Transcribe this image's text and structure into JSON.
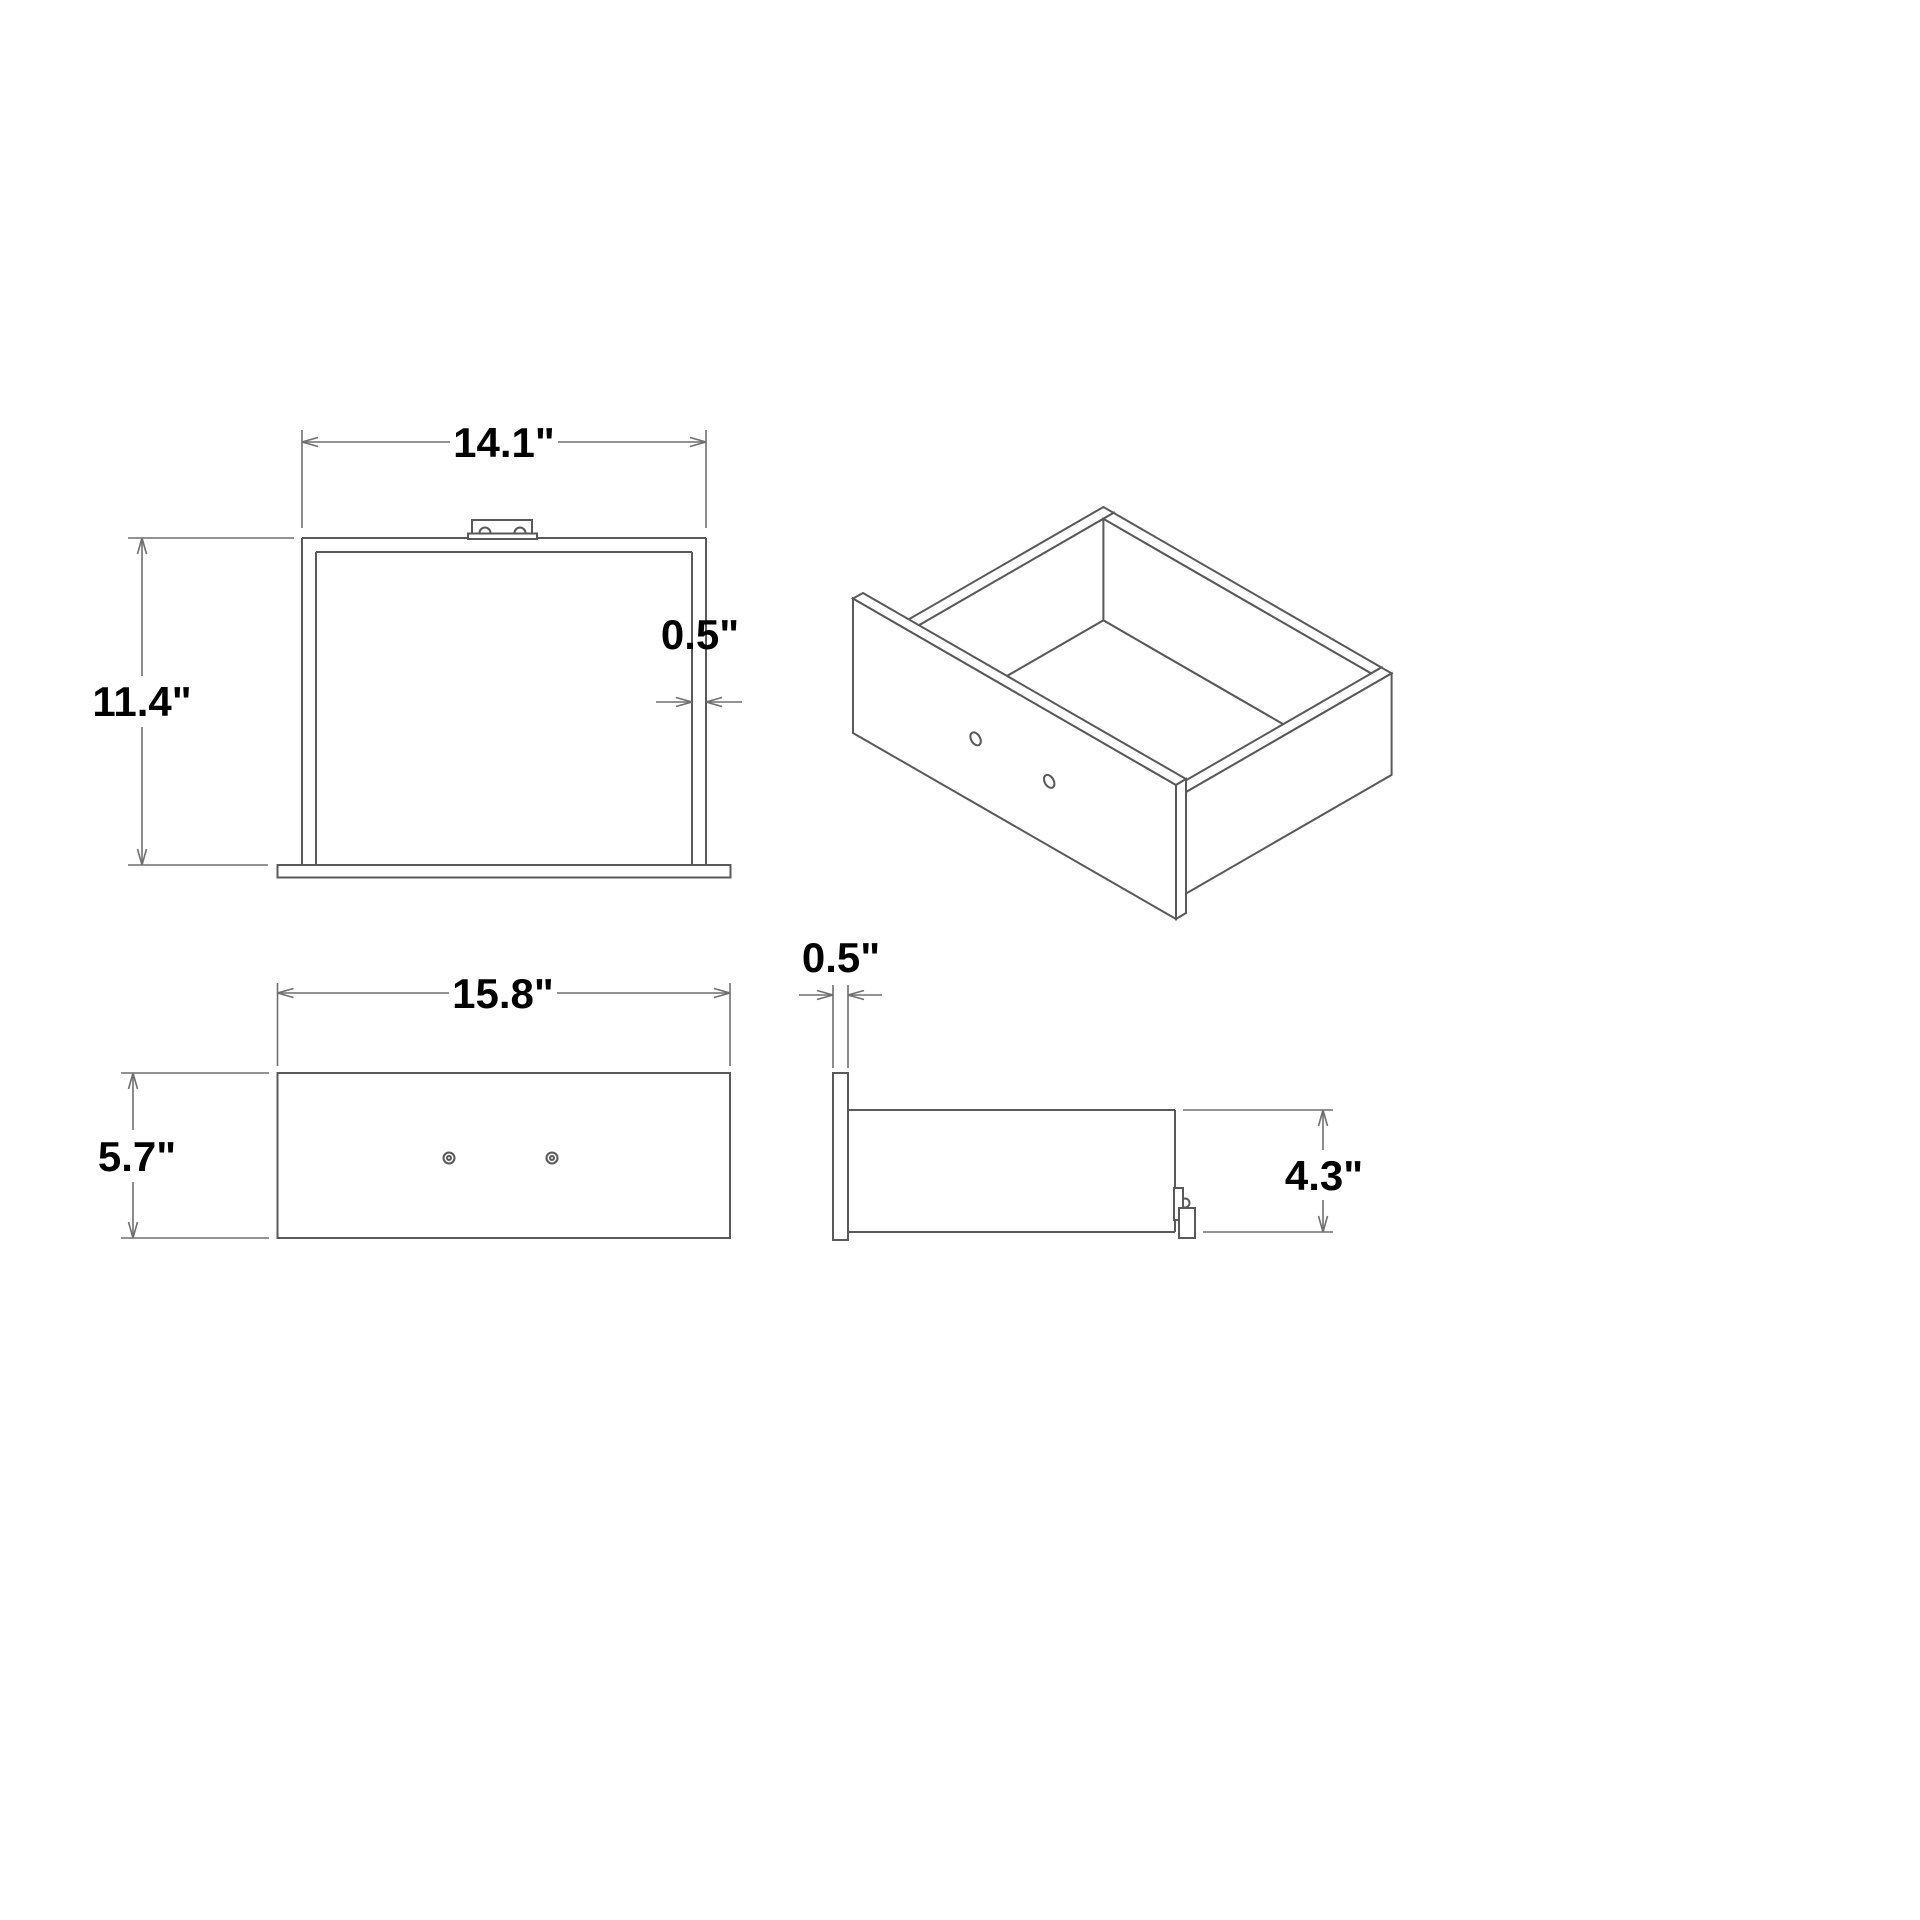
{
  "app": {
    "background": "#ffffff",
    "description": "technical dimension drawing of a drawer, four views"
  },
  "drawing": {
    "subject": "drawer",
    "unit": "inches",
    "colors": {
      "object_lines": "#595959",
      "dimension_lines": "#6f6f6f",
      "text": "#000000"
    }
  },
  "views": {
    "top_view": {
      "dims": {
        "width": {
          "label": "14.1\"",
          "value": 14.1
        },
        "depth": {
          "label": "11.4\"",
          "value": 11.4
        },
        "wall_thickness": {
          "label": "0.5\"",
          "value": 0.5
        }
      }
    },
    "isometric_view": {
      "front_panel_holes": 2
    },
    "front_view": {
      "dims": {
        "width": {
          "label": "15.8\"",
          "value": 15.8
        },
        "height": {
          "label": "5.7\"",
          "value": 5.7
        }
      }
    },
    "side_view": {
      "dims": {
        "front_panel_thickness": {
          "label": "0.5\"",
          "value": 0.5
        },
        "body_height": {
          "label": "4.3\"",
          "value": 4.3
        }
      }
    }
  }
}
